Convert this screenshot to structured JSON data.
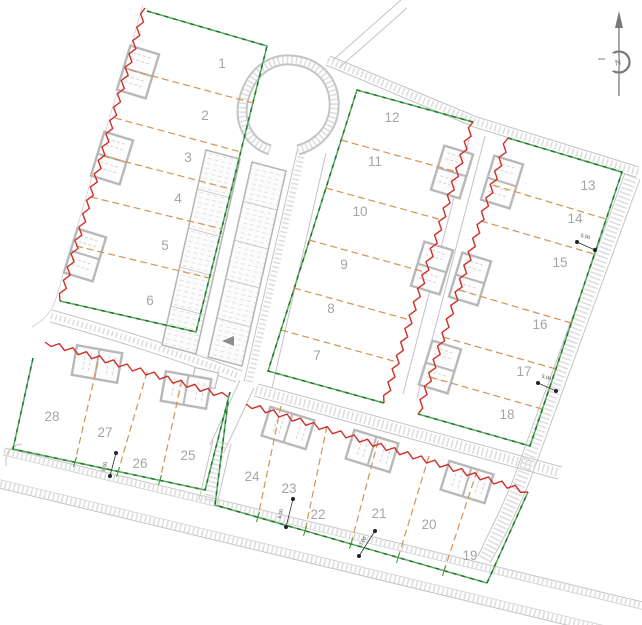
{
  "north": {
    "label": "N"
  },
  "lots": [
    "1",
    "2",
    "3",
    "4",
    "5",
    "6",
    "7",
    "8",
    "9",
    "10",
    "11",
    "12",
    "13",
    "14",
    "15",
    "16",
    "17",
    "18",
    "19",
    "20",
    "21",
    "22",
    "23",
    "24",
    "25",
    "26",
    "27",
    "28"
  ],
  "dims": [
    "5.00",
    "5.00",
    "5.00",
    "5.00",
    "3.00"
  ],
  "colors": {
    "boundary_green": "#2fa344",
    "lot_divider_orange": "#d69352",
    "zigzag_red": "#cf2f28",
    "road_gray": "#c4c4c4",
    "label_gray": "#a5a5a5",
    "dimension_black": "#222222"
  }
}
